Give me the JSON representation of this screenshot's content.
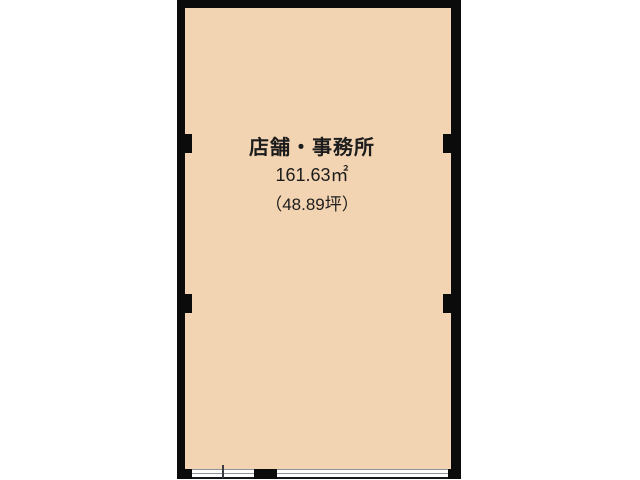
{
  "floor_plan": {
    "room": {
      "label": "店舗・事務所",
      "area_sqm": "161.63㎡",
      "area_tsubo": "（48.89坪）"
    },
    "features": {
      "windows": [
        "bottom-left-sliding-window",
        "bottom-right-sliding-window"
      ],
      "pillars": [
        "left-upper",
        "left-lower",
        "right-upper",
        "right-lower"
      ]
    },
    "colors": {
      "floor_fill": "#f2d3b2",
      "wall": "#0b0b0b",
      "text": "#1c1c1c",
      "window_line": "#8f949c",
      "window_edge": "#15181d",
      "background": "#ffffff"
    }
  }
}
